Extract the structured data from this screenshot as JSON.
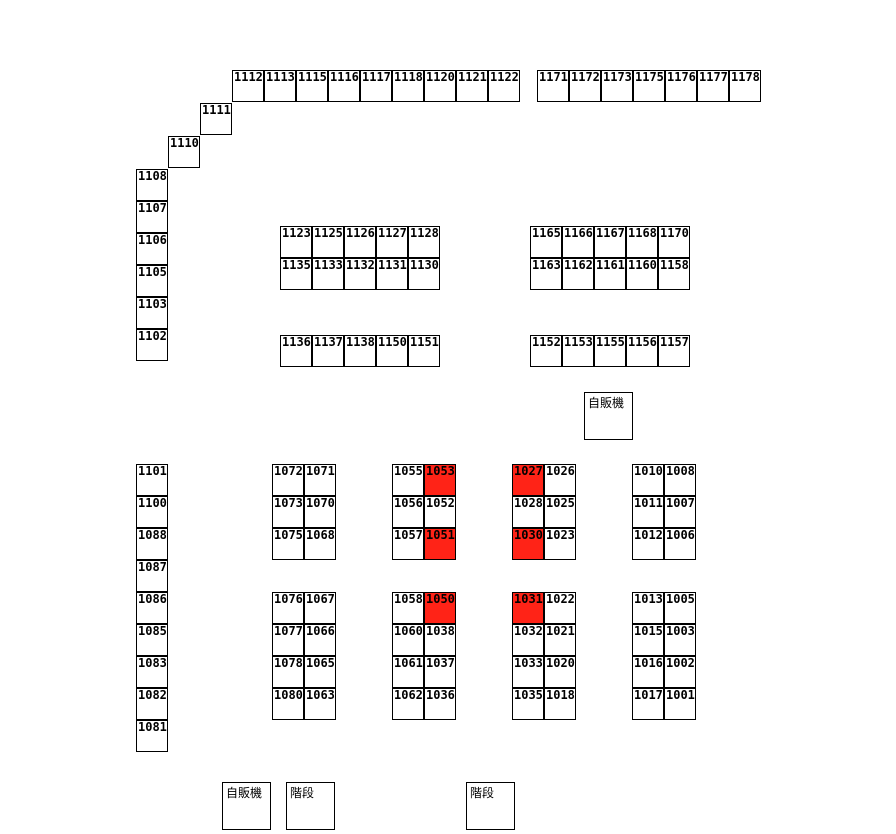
{
  "colors": {
    "highlight": "#ff2317",
    "cell_bg": "#ffffff",
    "border": "#000000",
    "text": "#000000"
  },
  "cell_size": 32,
  "highlighted": [
    "1053",
    "1051",
    "1027",
    "1030",
    "1050",
    "1031"
  ],
  "groups": [
    {
      "name": "top-row-left",
      "x": 232,
      "y": 70,
      "rows": [
        [
          "1112",
          "1113",
          "1115",
          "1116",
          "1117",
          "1118",
          "1120",
          "1121",
          "1122"
        ]
      ]
    },
    {
      "name": "top-row-right",
      "x": 537,
      "y": 70,
      "rows": [
        [
          "1171",
          "1172",
          "1173",
          "1175",
          "1176",
          "1177",
          "1178"
        ]
      ]
    },
    {
      "name": "stair-step-1111",
      "x": 200,
      "y": 103,
      "rows": [
        [
          "1111"
        ]
      ]
    },
    {
      "name": "stair-step-1110",
      "x": 168,
      "y": 136,
      "rows": [
        [
          "1110"
        ]
      ]
    },
    {
      "name": "left-column-upper",
      "x": 136,
      "y": 169,
      "rows": [
        [
          "1108"
        ],
        [
          "1107"
        ],
        [
          "1106"
        ],
        [
          "1105"
        ],
        [
          "1103"
        ],
        [
          "1102"
        ]
      ]
    },
    {
      "name": "center-left-double-row",
      "x": 280,
      "y": 226,
      "rows": [
        [
          "1123",
          "1125",
          "1126",
          "1127",
          "1128"
        ],
        [
          "1135",
          "1133",
          "1132",
          "1131",
          "1130"
        ]
      ]
    },
    {
      "name": "center-right-double-row",
      "x": 530,
      "y": 226,
      "rows": [
        [
          "1165",
          "1166",
          "1167",
          "1168",
          "1170"
        ],
        [
          "1163",
          "1162",
          "1161",
          "1160",
          "1158"
        ]
      ]
    },
    {
      "name": "center-left-single-row",
      "x": 280,
      "y": 335,
      "rows": [
        [
          "1136",
          "1137",
          "1138",
          "1150",
          "1151"
        ]
      ]
    },
    {
      "name": "center-right-single-row",
      "x": 530,
      "y": 335,
      "rows": [
        [
          "1152",
          "1153",
          "1155",
          "1156",
          "1157"
        ]
      ]
    },
    {
      "name": "left-column-lower",
      "x": 136,
      "y": 464,
      "rows": [
        [
          "1101"
        ],
        [
          "1100"
        ],
        [
          "1088"
        ],
        [
          "1087"
        ],
        [
          "1086"
        ],
        [
          "1085"
        ],
        [
          "1083"
        ],
        [
          "1082"
        ],
        [
          "1081"
        ]
      ]
    },
    {
      "name": "block-upper-1",
      "x": 272,
      "y": 464,
      "rows": [
        [
          "1072",
          "1071"
        ],
        [
          "1073",
          "1070"
        ],
        [
          "1075",
          "1068"
        ]
      ]
    },
    {
      "name": "block-upper-2",
      "x": 392,
      "y": 464,
      "rows": [
        [
          "1055",
          "1053"
        ],
        [
          "1056",
          "1052"
        ],
        [
          "1057",
          "1051"
        ]
      ]
    },
    {
      "name": "block-upper-3",
      "x": 512,
      "y": 464,
      "rows": [
        [
          "1027",
          "1026"
        ],
        [
          "1028",
          "1025"
        ],
        [
          "1030",
          "1023"
        ]
      ]
    },
    {
      "name": "block-upper-4",
      "x": 632,
      "y": 464,
      "rows": [
        [
          "1010",
          "1008"
        ],
        [
          "1011",
          "1007"
        ],
        [
          "1012",
          "1006"
        ]
      ]
    },
    {
      "name": "block-lower-1",
      "x": 272,
      "y": 592,
      "rows": [
        [
          "1076",
          "1067"
        ],
        [
          "1077",
          "1066"
        ],
        [
          "1078",
          "1065"
        ],
        [
          "1080",
          "1063"
        ]
      ]
    },
    {
      "name": "block-lower-2",
      "x": 392,
      "y": 592,
      "rows": [
        [
          "1058",
          "1050"
        ],
        [
          "1060",
          "1038"
        ],
        [
          "1061",
          "1037"
        ],
        [
          "1062",
          "1036"
        ]
      ]
    },
    {
      "name": "block-lower-3",
      "x": 512,
      "y": 592,
      "rows": [
        [
          "1031",
          "1022"
        ],
        [
          "1032",
          "1021"
        ],
        [
          "1033",
          "1020"
        ],
        [
          "1035",
          "1018"
        ]
      ]
    },
    {
      "name": "block-lower-4",
      "x": 632,
      "y": 592,
      "rows": [
        [
          "1013",
          "1005"
        ],
        [
          "1015",
          "1003"
        ],
        [
          "1016",
          "1002"
        ],
        [
          "1017",
          "1001"
        ]
      ]
    }
  ],
  "labels": {
    "vending_top": {
      "text": "自販機"
    },
    "vending_bottom": {
      "text": "自販機"
    },
    "stairs_left": {
      "text": "階段"
    },
    "stairs_right": {
      "text": "階段"
    }
  }
}
